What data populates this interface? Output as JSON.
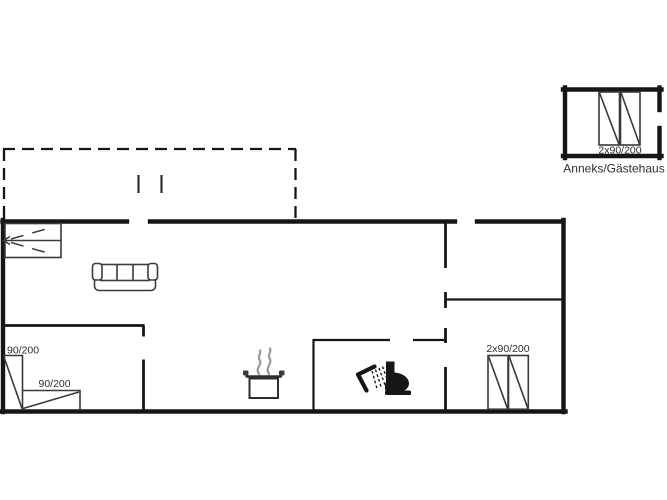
{
  "colors": {
    "wall": "#161616",
    "furniture": "#3a3a3a",
    "text": "#2e2e2e",
    "steam": "#9c9c9c",
    "background": "#ffffff"
  },
  "labels": {
    "bed_left_vertical": "90/200",
    "bed_left_horizontal": "90/200",
    "double_bed_main": "2x90/200",
    "annex_bed": "2x90/200",
    "annex_caption": "Anneks/Gästehaus"
  },
  "icons": {
    "sofa": "sofa-icon",
    "cooking_pot": "cooking-pot-icon",
    "shower": "shower-icon",
    "toilet": "toilet-icon",
    "bunk_bed": "bunk-bed-icon"
  }
}
